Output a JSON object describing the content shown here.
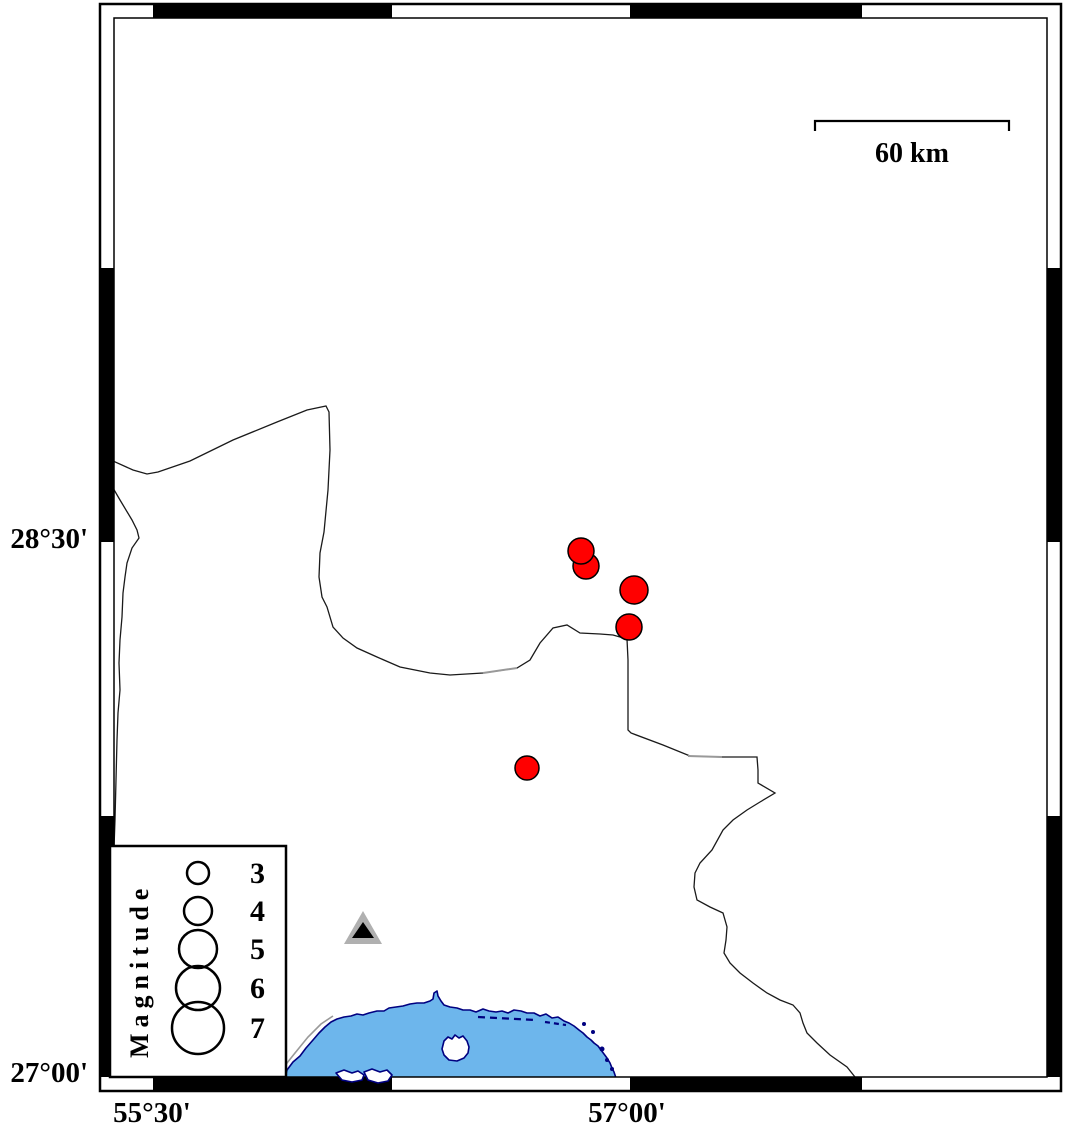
{
  "map": {
    "axis": {
      "left": [
        {
          "text": "28°30'"
        },
        {
          "text": "27°00'"
        }
      ],
      "bottom": [
        {
          "text": "55°30'"
        },
        {
          "text": "57°00'"
        }
      ]
    },
    "scalebar": {
      "label": "60 km",
      "length_km": 60
    },
    "legend": {
      "title": "Magnitude",
      "entries": [
        {
          "label": "3",
          "r": 11,
          "cy": 873
        },
        {
          "label": "4",
          "r": 14,
          "cy": 911
        },
        {
          "label": "5",
          "r": 19,
          "cy": 949
        },
        {
          "label": "6",
          "r": 22,
          "cy": 988
        },
        {
          "label": "7",
          "r": 26,
          "cy": 1028
        }
      ]
    },
    "epicenters": [
      {
        "x": 586,
        "y": 566,
        "r": 13
      },
      {
        "x": 581,
        "y": 551,
        "r": 13
      },
      {
        "x": 634,
        "y": 590,
        "r": 14
      },
      {
        "x": 629,
        "y": 627,
        "r": 13
      },
      {
        "x": 527,
        "y": 768,
        "r": 12
      }
    ],
    "station": {
      "x": 363,
      "y": 930,
      "symbol": "triangle"
    },
    "colors": {
      "epicenter": "#ff0000",
      "epicenter_outline": "#000000",
      "sea": "#6db6ec",
      "coastline": "#000080",
      "island_fill": "#ffffff",
      "station_fill": "#b0b0b0",
      "station_inner": "#000000",
      "border_line": "#1a1a1a",
      "road_overlay": "#999999",
      "frame": "#000000",
      "background": "#ffffff"
    }
  }
}
